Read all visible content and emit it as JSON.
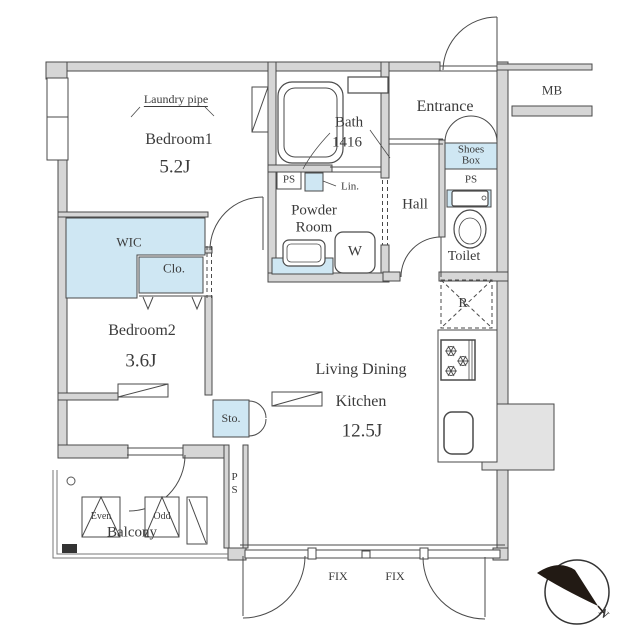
{
  "floorplan": {
    "rooms": {
      "bedroom1": {
        "name": "Bedroom1",
        "size": "5.2J"
      },
      "bedroom2": {
        "name": "Bedroom2",
        "size": "3.6J"
      },
      "ldk": {
        "line1": "Living Dining",
        "line2": "Kitchen",
        "size": "12.5J"
      },
      "bath": {
        "name": "Bath",
        "size": "1416"
      },
      "powder_room": {
        "line1": "Powder",
        "line2": "Room"
      },
      "entrance": "Entrance",
      "hall": "Hall",
      "toilet": "Toilet",
      "balcony": "Balcony"
    },
    "labels": {
      "laundry_pipe": "Laundry pipe",
      "wic": "WIC",
      "closet": "Clo.",
      "linen": "Lin.",
      "washing_machine": "W",
      "shoes_box_line1": "Shoes",
      "shoes_box_line2": "Box",
      "meter_box": "MB",
      "refrigerator": "R",
      "storage": "Sto.",
      "ps_bath": "PS",
      "ps_entrance": "PS",
      "ps_balcony": "PS",
      "fix_left": "FIX",
      "fix_right": "FIX",
      "washer_even": "Even",
      "washer_odd": "Odd",
      "north": "N"
    },
    "colors": {
      "fixture_blue": "#cfe7f3",
      "wall_gray": "#d6d6d6",
      "line_dark": "#444444",
      "compass_dark": "#221a14"
    }
  }
}
